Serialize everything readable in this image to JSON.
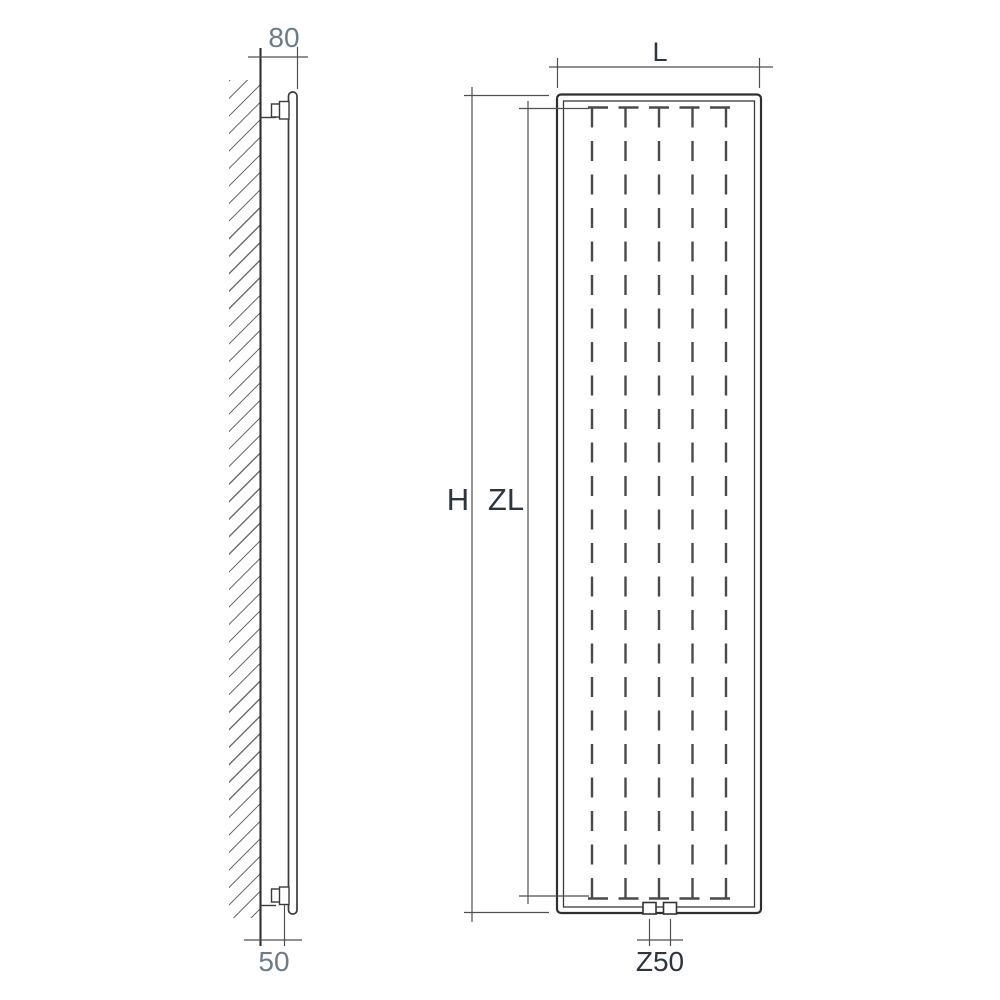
{
  "diagram": {
    "type": "technical-drawing",
    "subject": "Vertical panel radiator: wall-mounting side view (left) and front view (right) with dimension labels",
    "colors": {
      "background": "#ffffff",
      "outline": "#2f2f2f",
      "inner_line": "#3a3a3a",
      "dimension_line": "#4f4f4f",
      "dashed_core": "#4a4a4a",
      "hatch": "#6f6f6f",
      "label_dark": "#2d3540",
      "label_light": "#6d7c88"
    },
    "side_view": {
      "title": "side view with wall mounting",
      "wall_to_front_label": "80",
      "wall_to_connection_label": "50"
    },
    "front_view": {
      "title": "front view",
      "width_label": "L",
      "overall_height_label": "H",
      "core_height_label": "ZL",
      "connection_spacing_label": "Z50",
      "fin_lines": 5,
      "bottom_connections": 2
    }
  }
}
